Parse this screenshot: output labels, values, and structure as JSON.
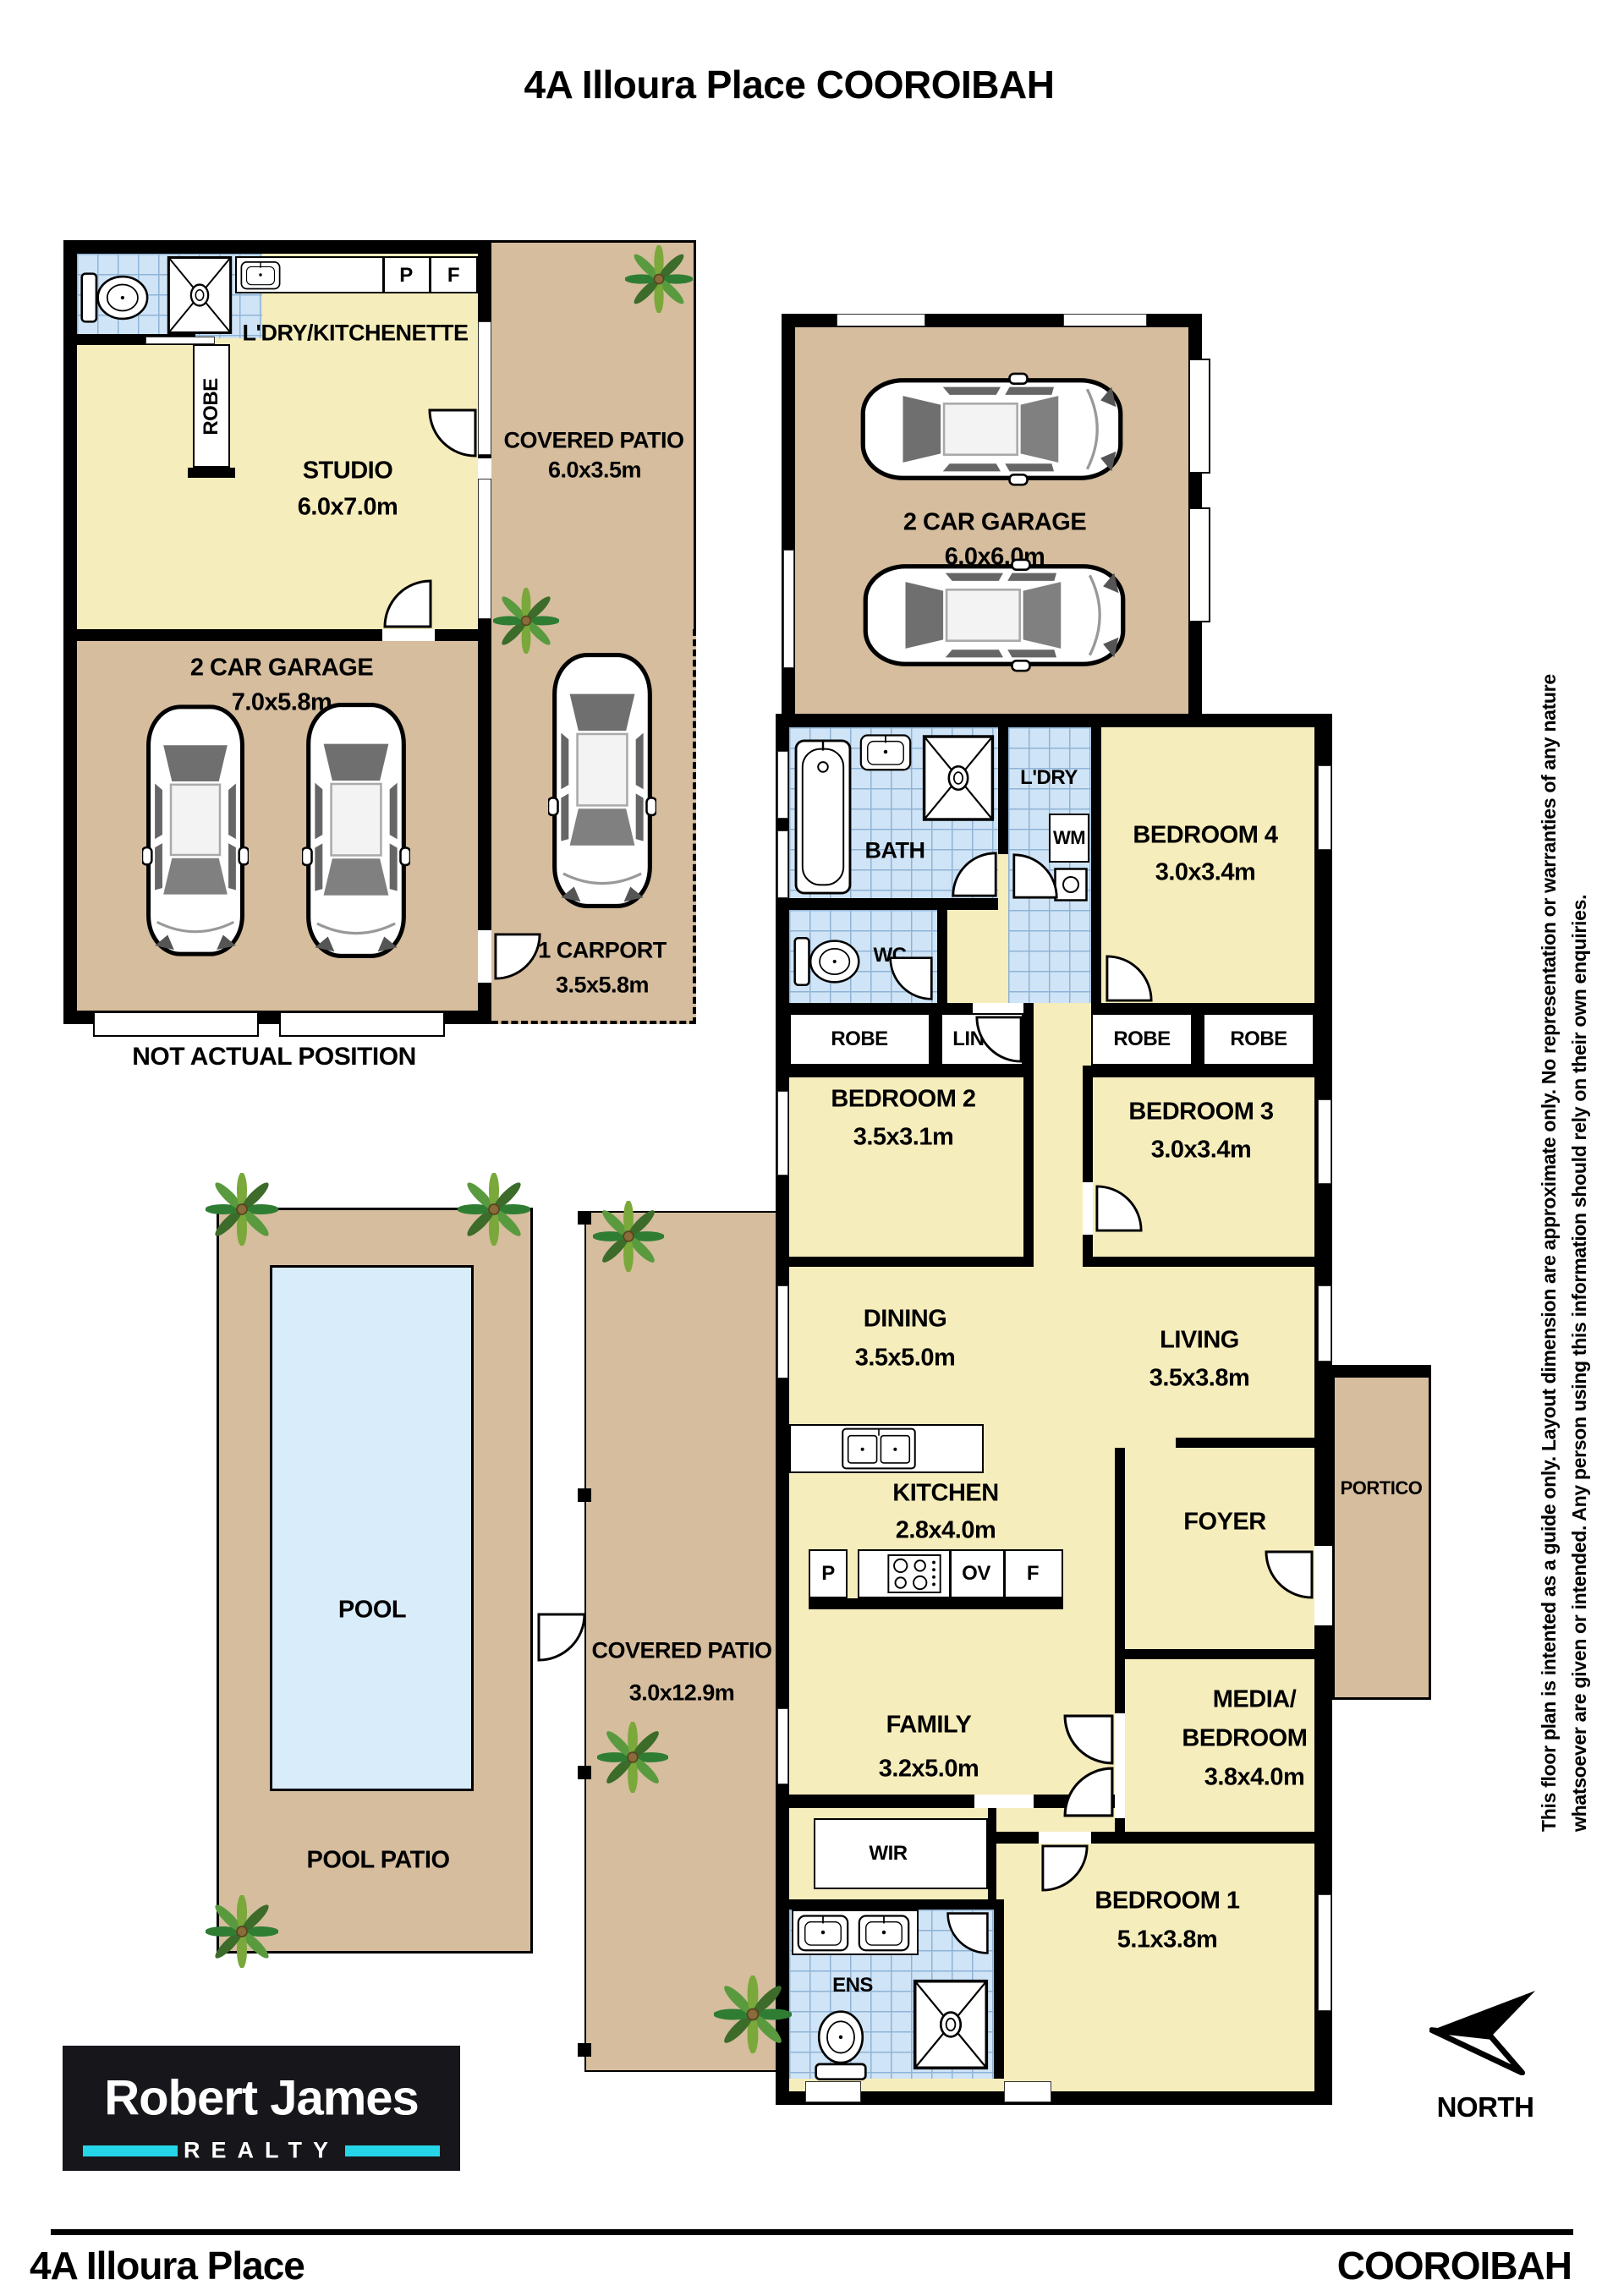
{
  "title": "4A Illoura Place COOROIBAH",
  "studio_building": {
    "ldry_kitchenette": "L'DRY/KITCHENETTE",
    "robe": "ROBE",
    "pantry": "P",
    "fridge": "F",
    "studio_label": "STUDIO",
    "studio_dims": "6.0x7.0m",
    "garage_label": "2 CAR GARAGE",
    "garage_dims": "7.0x5.8m",
    "patio_label": "COVERED PATIO",
    "patio_dims": "6.0x3.5m",
    "carport_label": "1 CARPORT",
    "carport_dims": "3.5x5.8m",
    "note": "NOT ACTUAL POSITION"
  },
  "main_house": {
    "garage_label": "2 CAR GARAGE",
    "garage_dims": "6.0x6.0m",
    "bath": "BATH",
    "ldry": "L'DRY",
    "wm": "WM",
    "wc": "WC",
    "bedroom4_label": "BEDROOM 4",
    "bedroom4_dims": "3.0x3.4m",
    "robe_a": "ROBE",
    "linen": "LINEN",
    "robe_b": "ROBE",
    "robe_c": "ROBE",
    "bedroom2_label": "BEDROOM 2",
    "bedroom2_dims": "3.5x3.1m",
    "bedroom3_label": "BEDROOM 3",
    "bedroom3_dims": "3.0x3.4m",
    "dining_label": "DINING",
    "dining_dims": "3.5x5.0m",
    "living_label": "LIVING",
    "living_dims": "3.5x3.8m",
    "kitchen_label": "KITCHEN",
    "kitchen_dims": "2.8x4.0m",
    "pantry": "P",
    "oven": "OV",
    "fridge": "F",
    "foyer": "FOYER",
    "portico": "PORTICO",
    "patio_label": "COVERED PATIO",
    "patio_dims": "3.0x12.9m",
    "family_label": "FAMILY",
    "family_dims": "3.2x5.0m",
    "media_label1": "MEDIA/",
    "media_label2": "BEDROOM 5",
    "media_dims": "3.8x4.0m",
    "wir": "WIR",
    "ens": "ENS",
    "bedroom1_label": "BEDROOM 1",
    "bedroom1_dims": "5.1x3.8m"
  },
  "pool_area": {
    "pool": "POOL",
    "pool_patio": "POOL PATIO"
  },
  "compass": {
    "label": "NORTH"
  },
  "disclaimer": {
    "line1": "This floor plan is intented as a guide only. Layout dimension are approximate only. No representation or warranties of any nature",
    "line2": "whatsoever are given or intended. Any person using this information should rely on their own enquiries."
  },
  "logo": {
    "name": "Robert James",
    "subtitle": "REALTY"
  },
  "footer": {
    "left": "4A Illoura Place",
    "right": "COOROIBAH"
  },
  "colors": {
    "room_fill": "#f6edbc",
    "patio_fill": "#d5bd9e",
    "tile_fill": "#cfe4f6",
    "pool_fill": "#d9ecfa",
    "wall": "#000000",
    "logo_accent": "#25d6e9"
  }
}
